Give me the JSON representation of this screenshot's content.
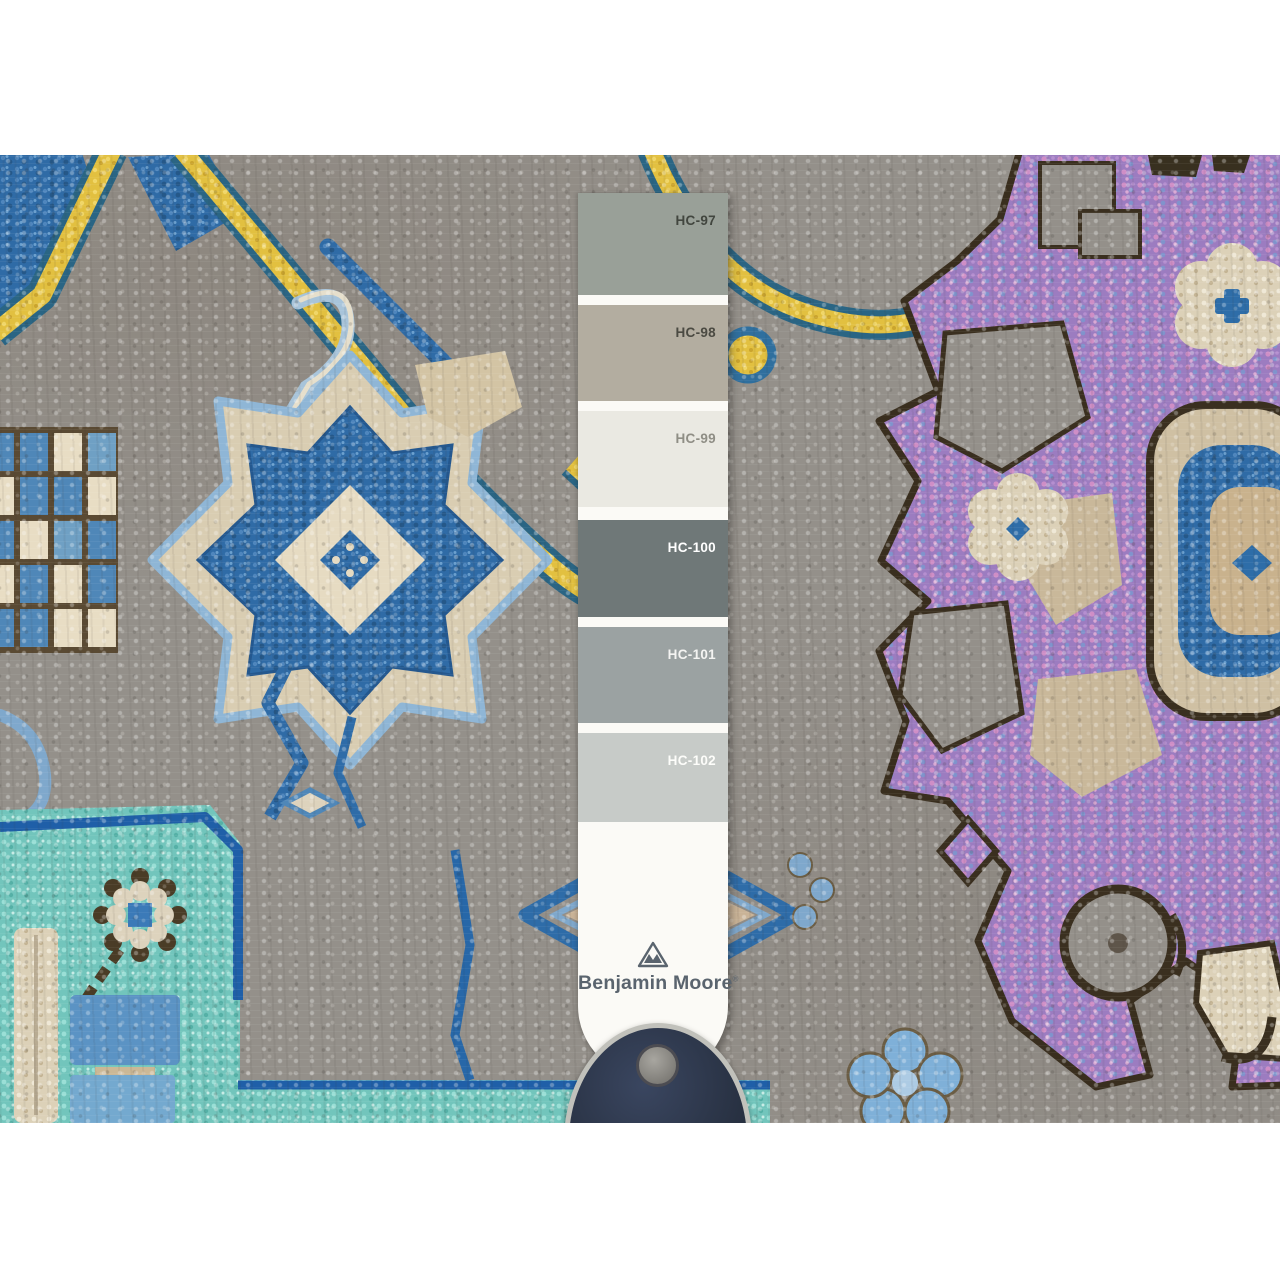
{
  "paint_strip": {
    "brand": "Benjamin Moore",
    "registered_mark": "®",
    "card_color": "#fbfaf6",
    "logo_color": "#5a646e",
    "swatches": [
      {
        "label": "HC-97",
        "color": "#99a098",
        "label_color": "#42463f"
      },
      {
        "label": "HC-98",
        "color": "#b3ada0",
        "label_color": "#4b4a42"
      },
      {
        "label": "HC-99",
        "color": "#eae9e2",
        "label_color": "#8f8e85"
      },
      {
        "label": "HC-100",
        "color": "#6f7878",
        "label_color": "#ffffff"
      },
      {
        "label": "HC-101",
        "color": "#9ba2a2",
        "label_color": "#f4f4f2"
      },
      {
        "label": "HC-102",
        "color": "#c7cbc8",
        "label_color": "#fdfdfa"
      }
    ]
  },
  "rug_palette": {
    "field_gray": "#94908a",
    "medallion_blue": "#2f6ba6",
    "light_blue": "#7fa8cc",
    "accent_yellow": "#e2c040",
    "turquoise": "#72c5bc",
    "orchid_purple": "#9c7cc0",
    "pink": "#cf8ec6",
    "cream": "#dcd1b8",
    "dark_brown": "#3a2f1f"
  },
  "tool": {
    "body_color": "#283142",
    "rim_color": "#c1c1bb",
    "knob_color": "#8d8b86"
  }
}
